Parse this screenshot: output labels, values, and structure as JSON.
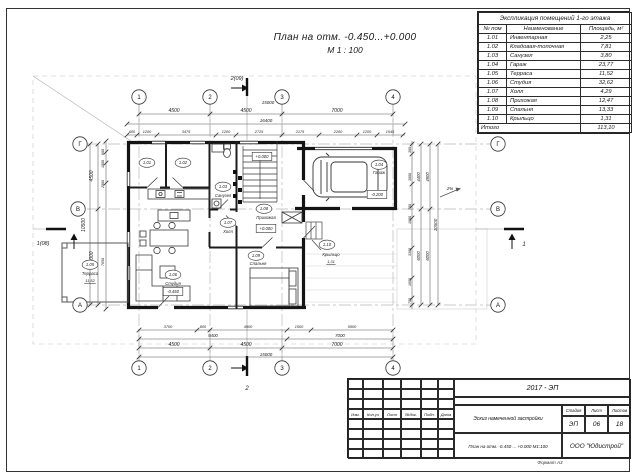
{
  "sheet": {
    "heading_line1": "План на отм. -0.450...+0.000",
    "heading_line2": "М 1 : 100",
    "format_note": "Формат А3"
  },
  "room_table": {
    "title": "Экспликация помещений 1-го этажа",
    "columns": [
      "№ пом",
      "Наименование",
      "Площадь, м²"
    ],
    "rows": [
      [
        "1.01",
        "Инвентарная",
        "2,25"
      ],
      [
        "1.02",
        "Кладовая-топочная",
        "7,81"
      ],
      [
        "1.03",
        "Санузел",
        "3,80"
      ],
      [
        "1.04",
        "Гараж",
        "23,77"
      ],
      [
        "1.05",
        "Терраса",
        "11,52"
      ],
      [
        "1.06",
        "Студия",
        "32,62"
      ],
      [
        "1.07",
        "Холл",
        "4,29"
      ],
      [
        "1.08",
        "Прихожая",
        "12,47"
      ],
      [
        "1.09",
        "Спальня",
        "13,33"
      ],
      [
        "1.10",
        "Крыльцо",
        "1,31"
      ]
    ],
    "total_label": "Итого",
    "total_value": "113,10"
  },
  "title_block": {
    "project_code": "2017 - ЭП",
    "rev_headers": [
      "Изм.",
      "Кол.уч",
      "Лист",
      "№док.",
      "Подп.",
      "Дата"
    ],
    "doc_title": "Эскиз намеченной застройки",
    "sheet_caption": "План на отм. -0.450 ... +0.000  М1:100",
    "company": "ООО \"Юдистрой\"",
    "stage_label": "Стадия",
    "sheet_label": "Лист",
    "sheets_label": "Листов",
    "stage": "ЭП",
    "sheet_no": "06",
    "sheets_total": "18"
  },
  "plan": {
    "axes": [
      {
        "l": "1",
        "x": 139,
        "y": 97
      },
      {
        "l": "2",
        "x": 210,
        "y": 97
      },
      {
        "l": "3",
        "x": 282,
        "y": 97
      },
      {
        "l": "4",
        "x": 393,
        "y": 97
      },
      {
        "l": "1",
        "x": 139,
        "y": 368
      },
      {
        "l": "2",
        "x": 210,
        "y": 368
      },
      {
        "l": "3",
        "x": 282,
        "y": 368
      },
      {
        "l": "4",
        "x": 393,
        "y": 368
      },
      {
        "l": "Г",
        "x": 80,
        "y": 144
      },
      {
        "l": "В",
        "x": 78,
        "y": 209
      },
      {
        "l": "А",
        "x": 80,
        "y": 305
      },
      {
        "l": "Г",
        "x": 498,
        "y": 144
      },
      {
        "l": "В",
        "x": 498,
        "y": 209
      },
      {
        "l": "А",
        "x": 498,
        "y": 305
      }
    ],
    "texts": [
      {
        "t": "2(09)",
        "x": 237,
        "y": 80,
        "s": 5.5
      },
      {
        "t": "15000",
        "x": 268,
        "y": 104,
        "s": 4.5
      },
      {
        "t": "4500",
        "x": 174,
        "y": 112,
        "s": 5
      },
      {
        "t": "4500",
        "x": 246,
        "y": 112,
        "s": 5
      },
      {
        "t": "7000",
        "x": 337,
        "y": 112,
        "s": 5
      },
      {
        "t": "16400",
        "x": 266,
        "y": 122,
        "s": 4.5
      },
      {
        "t": "600",
        "x": 132,
        "y": 133,
        "s": 3.8
      },
      {
        "t": "1200",
        "x": 147,
        "y": 133,
        "s": 3.8
      },
      {
        "t": "3475",
        "x": 186,
        "y": 133,
        "s": 3.8
      },
      {
        "t": "1200",
        "x": 226,
        "y": 133,
        "s": 3.8
      },
      {
        "t": "2725",
        "x": 259,
        "y": 133,
        "s": 3.8
      },
      {
        "t": "2175",
        "x": 300,
        "y": 133,
        "s": 3.8
      },
      {
        "t": "2260",
        "x": 338,
        "y": 133,
        "s": 3.8
      },
      {
        "t": "1200",
        "x": 367,
        "y": 133,
        "s": 3.8
      },
      {
        "t": "1545",
        "x": 390,
        "y": 133,
        "s": 3.8
      },
      {
        "t": "3700",
        "x": 168,
        "y": 328,
        "s": 3.8
      },
      {
        "t": "800",
        "x": 203,
        "y": 328,
        "s": 3.8
      },
      {
        "t": "4900",
        "x": 248,
        "y": 328,
        "s": 3.8
      },
      {
        "t": "1500",
        "x": 299,
        "y": 328,
        "s": 3.8
      },
      {
        "t": "5500",
        "x": 352,
        "y": 328,
        "s": 3.8
      },
      {
        "t": "9400",
        "x": 213,
        "y": 337,
        "s": 4.4
      },
      {
        "t": "7000",
        "x": 340,
        "y": 337,
        "s": 4.4
      },
      {
        "t": "4500",
        "x": 174,
        "y": 346,
        "s": 5
      },
      {
        "t": "4500",
        "x": 246,
        "y": 346,
        "s": 5
      },
      {
        "t": "7000",
        "x": 337,
        "y": 346,
        "s": 5
      },
      {
        "t": "15000",
        "x": 266,
        "y": 356,
        "s": 4.5
      },
      {
        "t": "2",
        "x": 247,
        "y": 390,
        "s": 6
      },
      {
        "t": "4500",
        "x": 93,
        "y": 176,
        "s": 5,
        "r": -90
      },
      {
        "t": "6000",
        "x": 93,
        "y": 257,
        "s": 5,
        "r": -90
      },
      {
        "t": "10500",
        "x": 85,
        "y": 225,
        "s": 5,
        "r": -90
      },
      {
        "t": "600",
        "x": 104,
        "y": 152,
        "s": 3.6,
        "r": -90
      },
      {
        "t": "1000",
        "x": 104,
        "y": 164,
        "s": 3.6,
        "r": -90
      },
      {
        "t": "2000",
        "x": 104,
        "y": 184,
        "s": 3.6,
        "r": -90
      },
      {
        "t": "7650",
        "x": 104,
        "y": 262,
        "s": 3.6,
        "r": -90
      },
      {
        "t": "1(08)",
        "x": 43,
        "y": 245,
        "s": 5.5
      },
      {
        "t": "300",
        "x": 411,
        "y": 150,
        "s": 3.6,
        "r": -90
      },
      {
        "t": "3000",
        "x": 411,
        "y": 177,
        "s": 3.6,
        "r": -90
      },
      {
        "t": "700",
        "x": 411,
        "y": 207,
        "s": 3.6,
        "r": -90
      },
      {
        "t": "1000",
        "x": 411,
        "y": 220,
        "s": 3.6,
        "r": -90
      },
      {
        "t": "3300",
        "x": 411,
        "y": 252,
        "s": 3.6,
        "r": -90
      },
      {
        "t": "1600",
        "x": 411,
        "y": 282,
        "s": 3.6,
        "r": -90
      },
      {
        "t": "700",
        "x": 411,
        "y": 301,
        "s": 3.6,
        "r": -90
      },
      {
        "t": "4400",
        "x": 420,
        "y": 177,
        "s": 4.2,
        "r": -90
      },
      {
        "t": "6000",
        "x": 420,
        "y": 256,
        "s": 4.2,
        "r": -90
      },
      {
        "t": "4900",
        "x": 429,
        "y": 177,
        "s": 4.2,
        "r": -90
      },
      {
        "t": "6000",
        "x": 429,
        "y": 256,
        "s": 4.2,
        "r": -90
      },
      {
        "t": "10500",
        "x": 437,
        "y": 225,
        "s": 4.5,
        "r": -90
      },
      {
        "t": "1",
        "x": 524,
        "y": 246,
        "s": 6
      },
      {
        "t": "2%",
        "x": 450,
        "y": 190,
        "s": 4.5
      },
      {
        "t": "1.01",
        "x": 147,
        "y": 164,
        "s": 4.2,
        "tag": true
      },
      {
        "t": "1.02",
        "x": 183,
        "y": 164,
        "s": 4.2,
        "tag": true
      },
      {
        "t": "1.03",
        "x": 223,
        "y": 188,
        "s": 4.2,
        "tag": true
      },
      {
        "t": "1.04",
        "x": 379,
        "y": 166,
        "s": 4.2,
        "tag": true
      },
      {
        "t": "1.05",
        "x": 90,
        "y": 266,
        "s": 4.2,
        "tag": true
      },
      {
        "t": "1.06",
        "x": 173,
        "y": 276,
        "s": 4.2,
        "tag": true
      },
      {
        "t": "1.07",
        "x": 228,
        "y": 224,
        "s": 4.2,
        "tag": true
      },
      {
        "t": "1.08",
        "x": 264,
        "y": 210,
        "s": 4.2,
        "tag": true
      },
      {
        "t": "1.09",
        "x": 256,
        "y": 257,
        "s": 4.2,
        "tag": true
      },
      {
        "t": "1.10",
        "x": 327,
        "y": 246,
        "s": 4.2,
        "tag": true
      },
      {
        "t": "Санузел",
        "x": 223,
        "y": 197,
        "s": 4.2
      },
      {
        "t": "Холл",
        "x": 228,
        "y": 233,
        "s": 4.2
      },
      {
        "t": "Прихожая",
        "x": 266,
        "y": 219,
        "s": 4.2
      },
      {
        "t": "Студия",
        "x": 173,
        "y": 285,
        "s": 4.2
      },
      {
        "t": "Спальня",
        "x": 258,
        "y": 265,
        "s": 4.2
      },
      {
        "t": "Гараж",
        "x": 379,
        "y": 174,
        "s": 4.2
      },
      {
        "t": "Терраса",
        "x": 90,
        "y": 275,
        "s": 4.2
      },
      {
        "t": "11,52",
        "x": 90,
        "y": 282,
        "s": 4,
        "ul": true
      },
      {
        "t": "Крыльцо",
        "x": 331,
        "y": 256,
        "s": 4.2
      },
      {
        "t": "1,31",
        "x": 331,
        "y": 263,
        "s": 4,
        "ul": true
      },
      {
        "t": "+0.000",
        "x": 262,
        "y": 158,
        "s": 4.2,
        "box": true
      },
      {
        "t": "+0.000",
        "x": 266,
        "y": 230,
        "s": 4.2,
        "box": true
      },
      {
        "t": "-0.200",
        "x": 377,
        "y": 196,
        "s": 4.2,
        "box": true
      },
      {
        "t": "-0.450",
        "x": 173,
        "y": 293,
        "s": 4.2,
        "box": true
      }
    ]
  }
}
